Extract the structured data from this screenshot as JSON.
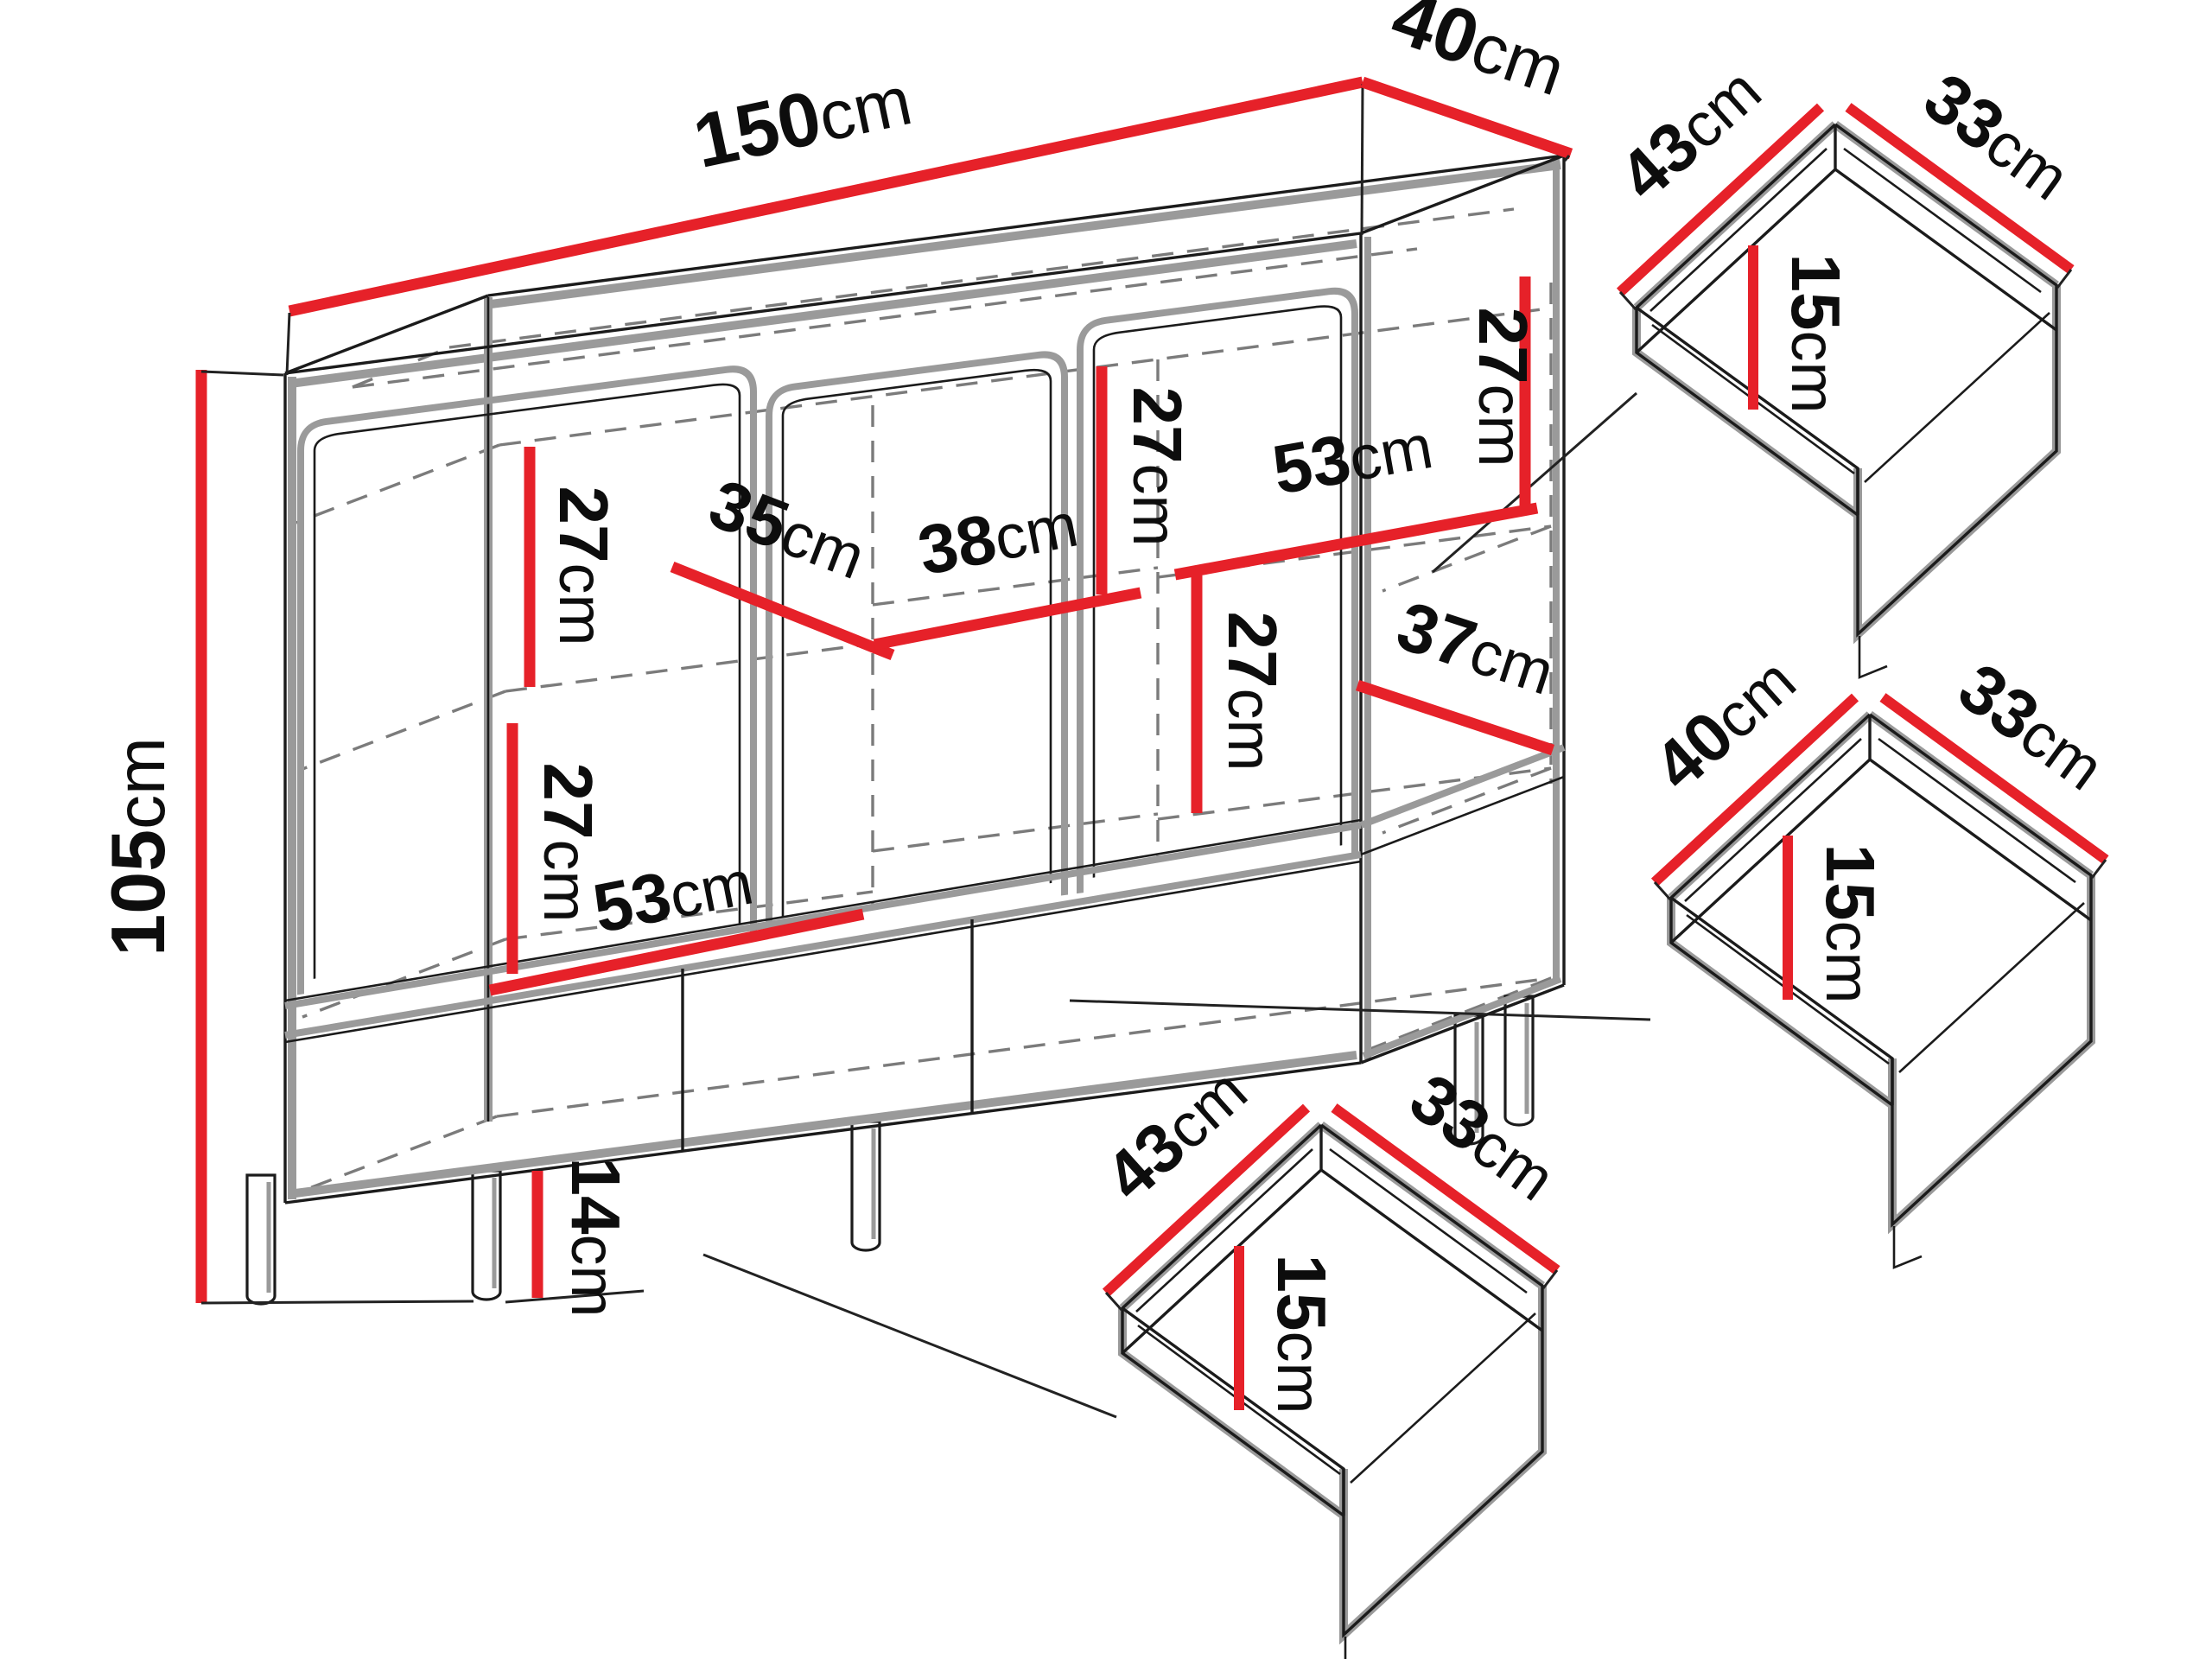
{
  "diagram": {
    "type": "furniture-dimension-diagram",
    "subject": "sideboard cabinet with three doors, open lower compartments and three inset drawers",
    "colors": {
      "dimension_line": "#e62129",
      "outline": "#1b1b1b",
      "shadow_outline": "#9a9a9a",
      "dashed_interior": "#7b7b7b",
      "background": "#ffffff"
    },
    "dimensions": {
      "width": {
        "num": "150",
        "unit": "cm"
      },
      "depth": {
        "num": "40",
        "unit": "cm"
      },
      "height": {
        "num": "105",
        "unit": "cm"
      },
      "leg_height": {
        "num": "14",
        "unit": "cm"
      },
      "interior": {
        "upper_left_height": {
          "num": "27",
          "unit": "cm"
        },
        "left_shelf_width": {
          "num": "35",
          "unit": "cm"
        },
        "middle_shelf_width": {
          "num": "38",
          "unit": "cm"
        },
        "upper_middle_height": {
          "num": "27",
          "unit": "cm"
        },
        "upper_right_shelf_width": {
          "num": "53",
          "unit": "cm"
        },
        "upper_right_height": {
          "num": "27",
          "unit": "cm"
        },
        "center_height": {
          "num": "27",
          "unit": "cm"
        },
        "lower_right_width": {
          "num": "37",
          "unit": "cm"
        },
        "lower_left_height": {
          "num": "27",
          "unit": "cm"
        },
        "lower_left_shelf_width": {
          "num": "53",
          "unit": "cm"
        }
      }
    },
    "drawers": [
      {
        "label": "top-right drawer",
        "width": {
          "num": "43",
          "unit": "cm"
        },
        "depth": {
          "num": "33",
          "unit": "cm"
        },
        "height": {
          "num": "15",
          "unit": "cm"
        }
      },
      {
        "label": "middle-right drawer",
        "width": {
          "num": "40",
          "unit": "cm"
        },
        "depth": {
          "num": "33",
          "unit": "cm"
        },
        "height": {
          "num": "15",
          "unit": "cm"
        }
      },
      {
        "label": "bottom-center drawer",
        "width": {
          "num": "43",
          "unit": "cm"
        },
        "depth": {
          "num": "33",
          "unit": "cm"
        },
        "height": {
          "num": "15",
          "unit": "cm"
        }
      }
    ]
  }
}
